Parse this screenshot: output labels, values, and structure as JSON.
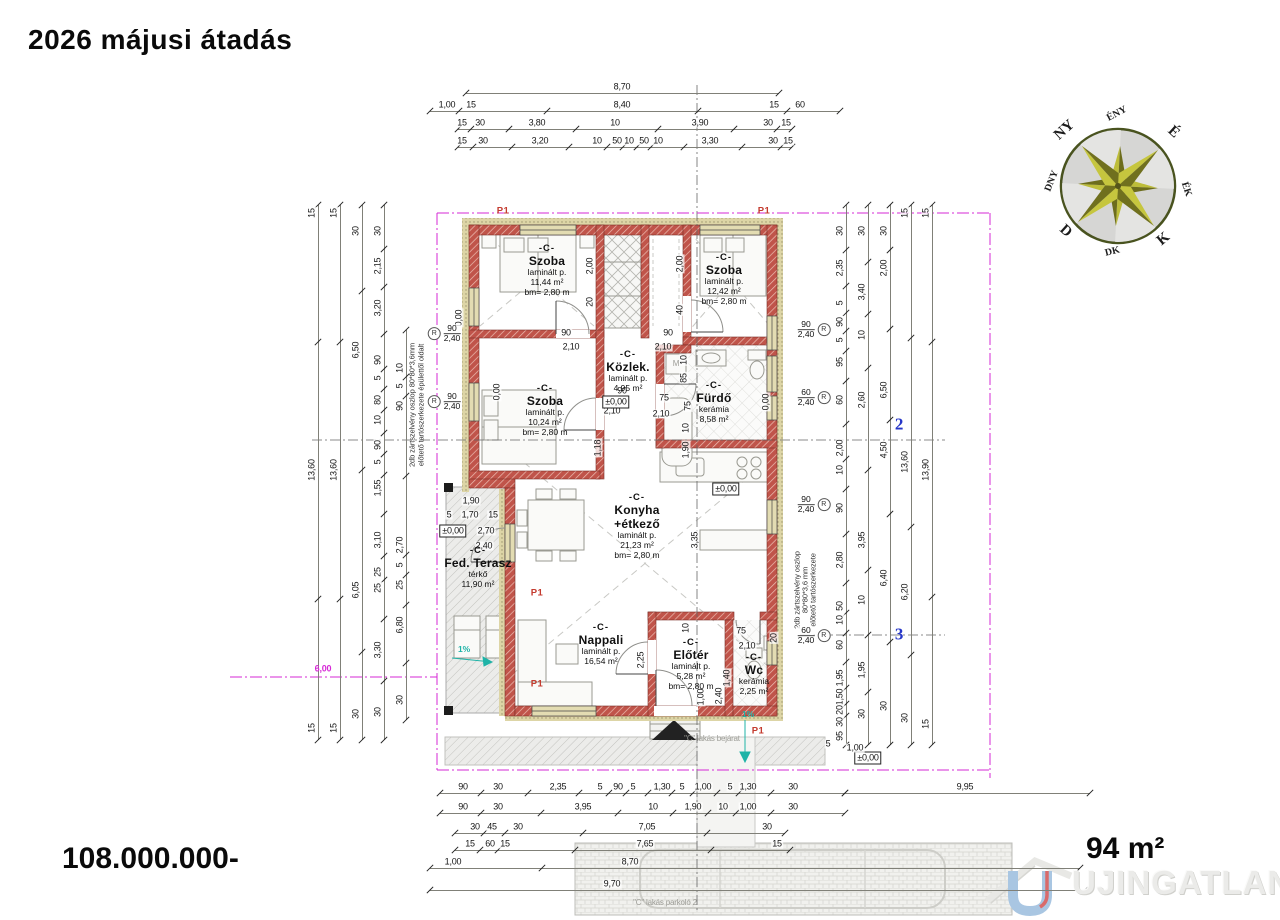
{
  "header": {
    "title": "2026 májusi átadás"
  },
  "footer": {
    "price": "108.000.000-",
    "area": "94 m²"
  },
  "watermark": {
    "text": "UJINGATLANOK.HU"
  },
  "colors": {
    "wall_red": "#c0544a",
    "insulation_tan": "#ddd5a6",
    "boundary_magenta": "#d629d6",
    "slope_teal": "#1fb3a7",
    "axis_blue": "#2636c8",
    "marker_red": "#c43b2f",
    "compass_olive": "#bdbd3a"
  },
  "compass": {
    "labels": [
      "ÉNY",
      "É",
      "ÉK",
      "K",
      "DK",
      "D",
      "DNY",
      "NY"
    ]
  },
  "plan": {
    "door_symbol": "R",
    "rooms": [
      {
        "x": 547,
        "y": 243,
        "code": "-C-",
        "name": [
          "Szoba"
        ],
        "info": [
          "laminált p.",
          "11,44 m²",
          "bm= 2,80 m"
        ]
      },
      {
        "x": 724,
        "y": 252,
        "code": "-C-",
        "name": [
          "Szoba"
        ],
        "info": [
          "laminált p.",
          "12,42 m²",
          "bm= 2,80 m"
        ]
      },
      {
        "x": 628,
        "y": 349,
        "code": "-C-",
        "name": [
          "Közlek."
        ],
        "info": [
          "laminált p.",
          "4,95 m²"
        ]
      },
      {
        "x": 714,
        "y": 380,
        "code": "-C-",
        "name": [
          "Fürdő"
        ],
        "info": [
          "kerámia",
          "8,58 m²"
        ]
      },
      {
        "x": 545,
        "y": 383,
        "code": "-C-",
        "name": [
          "Szoba"
        ],
        "info": [
          "laminált p.",
          "10,24 m²",
          "bm= 2,80 m"
        ]
      },
      {
        "x": 637,
        "y": 492,
        "code": "-C-",
        "name": [
          "Konyha",
          "+étkező"
        ],
        "info": [
          "laminált p.",
          "21,23 m²",
          "bm= 2,80 m"
        ]
      },
      {
        "x": 478,
        "y": 545,
        "code": "-C-",
        "name": [
          "Fed. Terasz"
        ],
        "info": [
          "térkő",
          "11,90 m²"
        ]
      },
      {
        "x": 601,
        "y": 622,
        "code": "-C-",
        "name": [
          "Nappali"
        ],
        "info": [
          "laminált p.",
          "16,54 m²"
        ]
      },
      {
        "x": 691,
        "y": 637,
        "code": "-C-",
        "name": [
          "Előtér"
        ],
        "info": [
          "laminált p.",
          "5,28 m²",
          "bm= 2,80 m"
        ]
      },
      {
        "x": 754,
        "y": 652,
        "code": "-C-",
        "name": [
          "Wc"
        ],
        "info": [
          "kerámia",
          "2,25 m²"
        ]
      }
    ],
    "chains": [
      {
        "o": "h",
        "x": 466,
        "y": 93,
        "len": 313,
        "labels": [
          [
            "8,70",
            622
          ]
        ]
      },
      {
        "o": "h",
        "x": 430,
        "y": 111,
        "len": 410,
        "labels": [
          [
            "1,00",
            447
          ],
          [
            "15",
            471
          ],
          [
            "8,40",
            622
          ],
          [
            "15",
            774
          ],
          [
            "60",
            800
          ]
        ]
      },
      {
        "o": "h",
        "x": 458,
        "y": 129,
        "len": 334,
        "labels": [
          [
            "15",
            462
          ],
          [
            "30",
            480
          ],
          [
            "3,80",
            537
          ],
          [
            "10",
            615
          ],
          [
            "3,90",
            700
          ],
          [
            "30",
            768
          ],
          [
            "15",
            786
          ]
        ]
      },
      {
        "o": "h",
        "x": 458,
        "y": 147,
        "len": 334,
        "labels": [
          [
            "15",
            462
          ],
          [
            "30",
            483
          ],
          [
            "3,20",
            540
          ],
          [
            "10",
            597
          ],
          [
            "50",
            617
          ],
          [
            "10",
            629
          ],
          [
            "50",
            644
          ],
          [
            "10",
            658
          ],
          [
            "3,30",
            710
          ],
          [
            "30",
            773
          ],
          [
            "15",
            788
          ]
        ]
      },
      {
        "o": "h",
        "x": 440,
        "y": 793,
        "len": 405,
        "labels": [
          [
            "90",
            463
          ],
          [
            "30",
            498
          ],
          [
            "2,35",
            558
          ],
          [
            "5",
            600
          ],
          [
            "90",
            618
          ],
          [
            "5",
            633
          ],
          [
            "1,30",
            662
          ],
          [
            "5",
            682
          ],
          [
            "1,00",
            703
          ],
          [
            "5",
            730
          ],
          [
            "1,30",
            748
          ],
          [
            "30",
            793
          ]
        ]
      },
      {
        "o": "h",
        "x": 845,
        "y": 793,
        "len": 245,
        "labels": [
          [
            "9,95",
            965
          ]
        ]
      },
      {
        "o": "h",
        "x": 440,
        "y": 813,
        "len": 405,
        "labels": [
          [
            "90",
            463
          ],
          [
            "30",
            498
          ],
          [
            "3,95",
            583
          ],
          [
            "10",
            653
          ],
          [
            "1,90",
            693
          ],
          [
            "10",
            723
          ],
          [
            "1,00",
            748
          ],
          [
            "30",
            793
          ]
        ]
      },
      {
        "o": "h",
        "x": 455,
        "y": 833,
        "len": 330,
        "labels": [
          [
            "30",
            475
          ],
          [
            "45",
            492
          ],
          [
            "30",
            518
          ],
          [
            "7,05",
            647
          ],
          [
            "30",
            767
          ]
        ]
      },
      {
        "o": "h",
        "x": 455,
        "y": 850,
        "len": 335,
        "labels": [
          [
            "15",
            470
          ],
          [
            "60",
            490
          ],
          [
            "15",
            505
          ],
          [
            "7,65",
            645
          ],
          [
            "15",
            777
          ]
        ]
      },
      {
        "o": "h",
        "x": 430,
        "y": 868,
        "len": 650,
        "labels": [
          [
            "1,00",
            453
          ],
          [
            "8,70",
            630
          ]
        ]
      },
      {
        "o": "h",
        "x": 430,
        "y": 890,
        "len": 655,
        "labels": [
          [
            "9,70",
            612
          ]
        ]
      },
      {
        "o": "v",
        "x": 318,
        "y": 205,
        "len": 535,
        "labels": [
          [
            "15",
            213
          ],
          [
            "13,60",
            470
          ],
          [
            "15",
            728
          ]
        ]
      },
      {
        "o": "v",
        "x": 340,
        "y": 205,
        "len": 535,
        "labels": [
          [
            "15",
            213
          ],
          [
            "13,60",
            470
          ],
          [
            "15",
            728
          ]
        ]
      },
      {
        "o": "v",
        "x": 362,
        "y": 205,
        "len": 535,
        "labels": [
          [
            "30",
            231
          ],
          [
            "6,50",
            350
          ],
          [
            "6,05",
            590
          ],
          [
            "30",
            714
          ]
        ]
      },
      {
        "o": "v",
        "x": 384,
        "y": 205,
        "len": 535,
        "labels": [
          [
            "30",
            231
          ],
          [
            "2,15",
            266
          ],
          [
            "3,20",
            308
          ],
          [
            "90",
            360
          ],
          [
            "5",
            378
          ],
          [
            "80",
            400
          ],
          [
            "10",
            420
          ],
          [
            "90",
            445
          ],
          [
            "5",
            462
          ],
          [
            "1,55",
            488
          ],
          [
            "3,10",
            540
          ],
          [
            "25",
            572
          ],
          [
            "25",
            588
          ],
          [
            "3,30",
            650
          ],
          [
            "30",
            712
          ]
        ]
      },
      {
        "o": "v",
        "x": 406,
        "y": 330,
        "len": 390,
        "labels": [
          [
            "10",
            368
          ],
          [
            "5",
            386
          ],
          [
            "90",
            406
          ],
          [
            "2,70",
            545
          ],
          [
            "5",
            565
          ],
          [
            "25",
            585
          ],
          [
            "6,80",
            625
          ],
          [
            "30",
            700
          ]
        ]
      },
      {
        "o": "v",
        "x": 846,
        "y": 205,
        "len": 540,
        "labels": [
          [
            "30",
            231
          ],
          [
            "2,35",
            268
          ],
          [
            "5",
            303
          ],
          [
            "90",
            322
          ],
          [
            "5",
            340
          ],
          [
            "95",
            362
          ],
          [
            "60",
            400
          ],
          [
            "2,00",
            448
          ],
          [
            "10",
            470
          ],
          [
            "90",
            508
          ],
          [
            "2,80",
            560
          ],
          [
            "50",
            606
          ],
          [
            "10",
            620
          ],
          [
            "60",
            645
          ],
          [
            "1,95",
            678
          ],
          [
            "1,50",
            697
          ],
          [
            "20",
            710
          ],
          [
            "30",
            722
          ]
        ]
      },
      {
        "o": "v",
        "x": 868,
        "y": 205,
        "len": 540,
        "labels": [
          [
            "30",
            231
          ],
          [
            "3,40",
            292
          ],
          [
            "10",
            335
          ],
          [
            "2,60",
            400
          ],
          [
            "3,95",
            540
          ],
          [
            "10",
            600
          ],
          [
            "1,95",
            670
          ],
          [
            "30",
            714
          ]
        ]
      },
      {
        "o": "v",
        "x": 890,
        "y": 205,
        "len": 540,
        "labels": [
          [
            "30",
            231
          ],
          [
            "2,00",
            268
          ],
          [
            "6,50",
            390
          ],
          [
            "4,50",
            450
          ],
          [
            "6,40",
            578
          ],
          [
            "30",
            706
          ]
        ]
      },
      {
        "o": "v",
        "x": 911,
        "y": 205,
        "len": 540,
        "labels": [
          [
            "15",
            213
          ],
          [
            "13,60",
            462
          ],
          [
            "6,20",
            592
          ],
          [
            "30",
            718
          ]
        ]
      },
      {
        "o": "v",
        "x": 932,
        "y": 205,
        "len": 540,
        "labels": [
          [
            "15",
            213
          ],
          [
            "13,90",
            470
          ],
          [
            "15",
            724
          ]
        ]
      }
    ],
    "door_markers": [
      {
        "x": 806,
        "y": 330,
        "a": "90",
        "b": "2,40",
        "s": "r"
      },
      {
        "x": 806,
        "y": 398,
        "a": "60",
        "b": "2,40",
        "s": "r"
      },
      {
        "x": 806,
        "y": 505,
        "a": "90",
        "b": "2,40",
        "s": "r"
      },
      {
        "x": 806,
        "y": 636,
        "a": "60",
        "b": "2,40",
        "s": "r"
      },
      {
        "x": 452,
        "y": 334,
        "a": "90",
        "b": "2,40",
        "s": "l"
      },
      {
        "x": 452,
        "y": 402,
        "a": "90",
        "b": "2,40",
        "s": "l"
      }
    ],
    "texts": [
      {
        "t": "90",
        "x": 566,
        "y": 333
      },
      {
        "t": "2,10",
        "x": 571,
        "y": 347
      },
      {
        "t": "90",
        "x": 668,
        "y": 333
      },
      {
        "t": "2,10",
        "x": 663,
        "y": 347
      },
      {
        "t": "90",
        "x": 622,
        "y": 391
      },
      {
        "t": "2,10",
        "x": 612,
        "y": 411
      },
      {
        "t": "±0,00",
        "x": 616,
        "y": 402,
        "cls": "boxed",
        "n": "level-marker"
      },
      {
        "t": "75",
        "x": 664,
        "y": 398
      },
      {
        "t": "2,10",
        "x": 661,
        "y": 414
      },
      {
        "t": "10",
        "x": 684,
        "y": 360,
        "rot": 1
      },
      {
        "t": "85",
        "x": 684,
        "y": 378,
        "rot": 1
      },
      {
        "t": "75",
        "x": 688,
        "y": 406,
        "rot": 1
      },
      {
        "t": "10",
        "x": 686,
        "y": 428,
        "rot": 1
      },
      {
        "t": "1,90",
        "x": 686,
        "y": 450,
        "rot": 1
      },
      {
        "t": "±0,00",
        "x": 726,
        "y": 489,
        "cls": "boxed",
        "n": "level-marker"
      },
      {
        "t": "3,35",
        "x": 695,
        "y": 540,
        "rot": 1
      },
      {
        "t": "2,25",
        "x": 641,
        "y": 660,
        "rot": 1
      },
      {
        "t": "75",
        "x": 741,
        "y": 631
      },
      {
        "t": "2,10",
        "x": 747,
        "y": 646
      },
      {
        "t": "20",
        "x": 774,
        "y": 638,
        "rot": 1
      },
      {
        "t": "1,40",
        "x": 727,
        "y": 678,
        "rot": 1
      },
      {
        "t": "2,40",
        "x": 719,
        "y": 696,
        "rot": 1
      },
      {
        "t": "1,00",
        "x": 701,
        "y": 697,
        "rot": 1
      },
      {
        "t": "10",
        "x": 686,
        "y": 628,
        "rot": 1
      },
      {
        "t": "1,18",
        "x": 598,
        "y": 448,
        "rot": 1
      },
      {
        "t": "2,00",
        "x": 590,
        "y": 266,
        "rot": 1
      },
      {
        "t": "20",
        "x": 590,
        "y": 302,
        "rot": 1
      },
      {
        "t": "2,00",
        "x": 680,
        "y": 264,
        "rot": 1
      },
      {
        "t": "40",
        "x": 680,
        "y": 310,
        "rot": 1
      },
      {
        "t": "0,00",
        "x": 459,
        "y": 318,
        "rot": 1
      },
      {
        "t": "0,00",
        "x": 497,
        "y": 392,
        "rot": 1
      },
      {
        "t": "0,00",
        "x": 766,
        "y": 402,
        "rot": 1
      },
      {
        "t": "1,90",
        "x": 471,
        "y": 501
      },
      {
        "t": "5",
        "x": 449,
        "y": 515
      },
      {
        "t": "1,70",
        "x": 470,
        "y": 515
      },
      {
        "t": "15",
        "x": 493,
        "y": 515
      },
      {
        "t": "±0,00",
        "x": 453,
        "y": 531,
        "cls": "boxed",
        "n": "level-marker"
      },
      {
        "t": "2,70",
        "x": 486,
        "y": 531
      },
      {
        "t": "2,40",
        "x": 484,
        "y": 546
      },
      {
        "t": "M",
        "x": 676,
        "y": 364,
        "cls": "gray-sm",
        "n": "washer-symbol"
      },
      {
        "t": "6,00",
        "x": 323,
        "y": 669,
        "cls": "magenta",
        "n": "boundary-dimension"
      },
      {
        "t": "±0,00",
        "x": 868,
        "y": 758,
        "cls": "boxed",
        "n": "level-marker"
      },
      {
        "t": "5",
        "x": 828,
        "y": 744
      },
      {
        "t": "95",
        "x": 840,
        "y": 736,
        "rot": 1
      },
      {
        "t": "1,00",
        "x": 855,
        "y": 748
      },
      {
        "t": "2",
        "x": 899,
        "y": 424,
        "cls": "axis-num",
        "n": "axis-number"
      },
      {
        "t": "3",
        "x": 899,
        "y": 634,
        "cls": "axis-num",
        "n": "axis-number"
      },
      {
        "t": "P1",
        "x": 503,
        "y": 211,
        "cls": "p1",
        "n": "panel-marker"
      },
      {
        "t": "P1",
        "x": 764,
        "y": 211,
        "cls": "p1",
        "n": "panel-marker"
      },
      {
        "t": "P1",
        "x": 537,
        "y": 593,
        "cls": "p1",
        "n": "panel-marker"
      },
      {
        "t": "P1",
        "x": 537,
        "y": 684,
        "cls": "p1",
        "n": "panel-marker"
      },
      {
        "t": "P1",
        "x": 758,
        "y": 731,
        "cls": "p1",
        "n": "panel-marker"
      },
      {
        "t": "1%",
        "x": 464,
        "y": 649,
        "cls": "teal",
        "n": "slope-label"
      },
      {
        "t": "1%",
        "x": 748,
        "y": 714,
        "cls": "teal",
        "n": "slope-label"
      },
      {
        "t": "\"C\" lakás bejárat",
        "x": 712,
        "y": 739,
        "cls": "gray-sm",
        "n": "entrance-note"
      },
      {
        "t": "\"C\" lakás parkoló 2",
        "x": 665,
        "y": 903,
        "cls": "gray-sm",
        "n": "parking-note"
      },
      {
        "t": "2db zártszelvény oszlop 80*80*3,6mm",
        "x": 412,
        "y": 405,
        "rot": 1,
        "cls": "ann",
        "n": "annotation"
      },
      {
        "t": "előtető tartószerkezete épülettől oldalt",
        "x": 421,
        "y": 405,
        "rot": 1,
        "cls": "ann",
        "n": "annotation"
      },
      {
        "t": "2db zártszelvény oszlop",
        "x": 797,
        "y": 590,
        "rot": 1,
        "cls": "ann",
        "n": "annotation"
      },
      {
        "t": "80*80*3,6 mm",
        "x": 805,
        "y": 590,
        "rot": 1,
        "cls": "ann",
        "n": "annotation"
      },
      {
        "t": "előtető tartószerkezete",
        "x": 813,
        "y": 590,
        "rot": 1,
        "cls": "ann",
        "n": "annotation"
      }
    ]
  }
}
